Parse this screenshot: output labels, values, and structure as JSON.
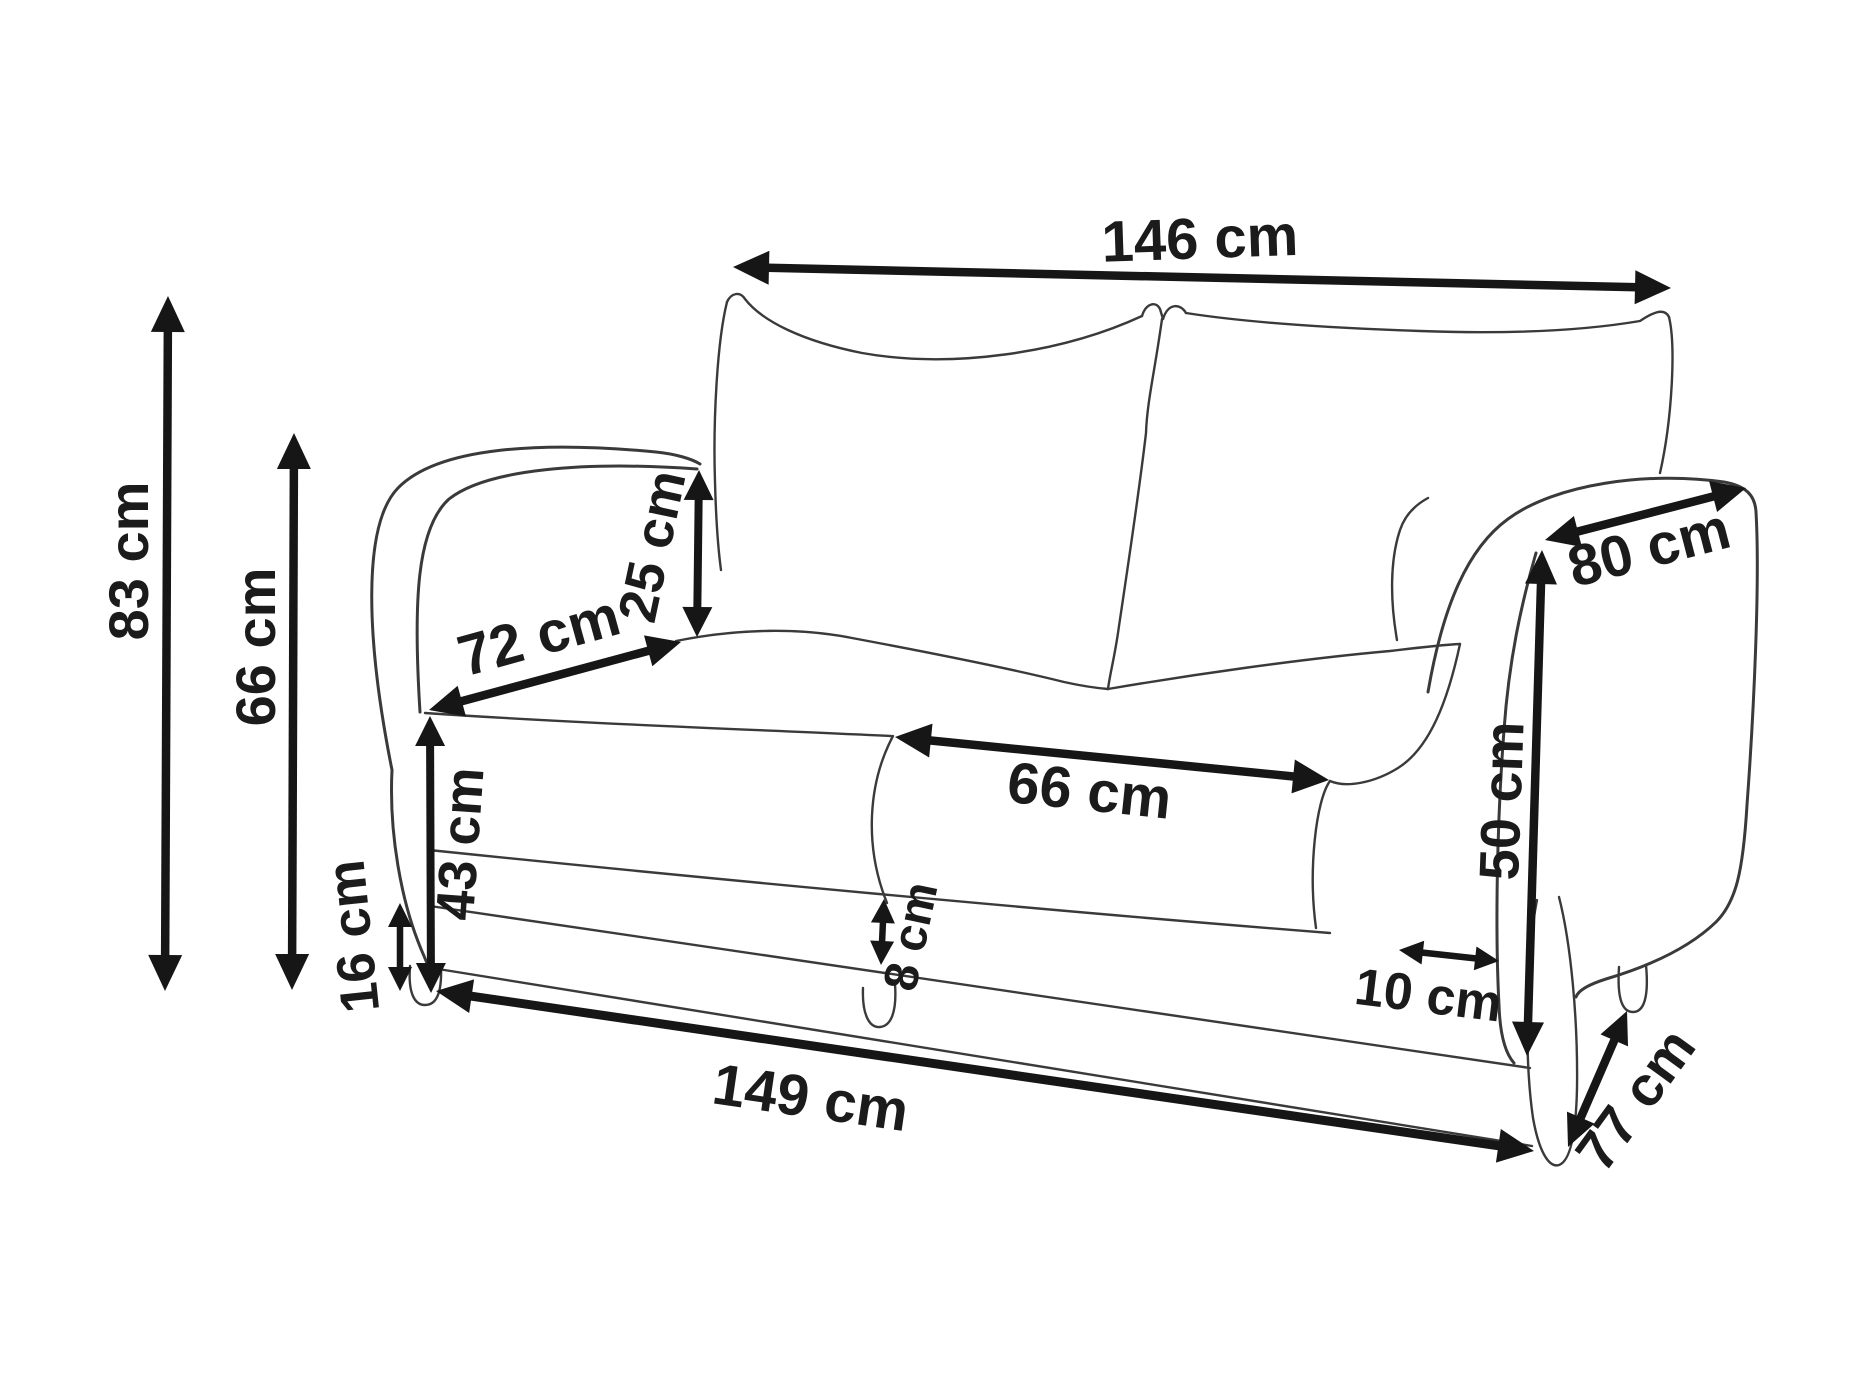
{
  "diagram": {
    "unit": "cm",
    "colors": {
      "background": "#ffffff",
      "outline": "#3a3a3a",
      "arrows": "#161616",
      "labels": "#1b1b1b"
    },
    "dimensions": [
      {
        "id": "overall-top-width",
        "label": "146 cm",
        "value": 146
      },
      {
        "id": "overall-height",
        "label": "83 cm",
        "value": 83
      },
      {
        "id": "arm-height",
        "label": "66 cm",
        "value": 66
      },
      {
        "id": "back-cushion-height",
        "label": "25 cm",
        "value": 25
      },
      {
        "id": "seat-depth",
        "label": "72 cm",
        "value": 72
      },
      {
        "id": "arm-top-depth",
        "label": "80 cm",
        "value": 80
      },
      {
        "id": "arm-front-height",
        "label": "50 cm",
        "value": 50
      },
      {
        "id": "seat-width",
        "label": "66 cm",
        "value": 66
      },
      {
        "id": "seat-front-height",
        "label": "43 cm",
        "value": 43
      },
      {
        "id": "base-height",
        "label": "16 cm",
        "value": 16
      },
      {
        "id": "frame-strip-height",
        "label": "8 cm",
        "value": 8
      },
      {
        "id": "arm-front-width",
        "label": "10 cm",
        "value": 10
      },
      {
        "id": "overall-bottom-width",
        "label": "149 cm",
        "value": 149
      },
      {
        "id": "overall-depth",
        "label": "77 cm",
        "value": 77
      }
    ]
  }
}
